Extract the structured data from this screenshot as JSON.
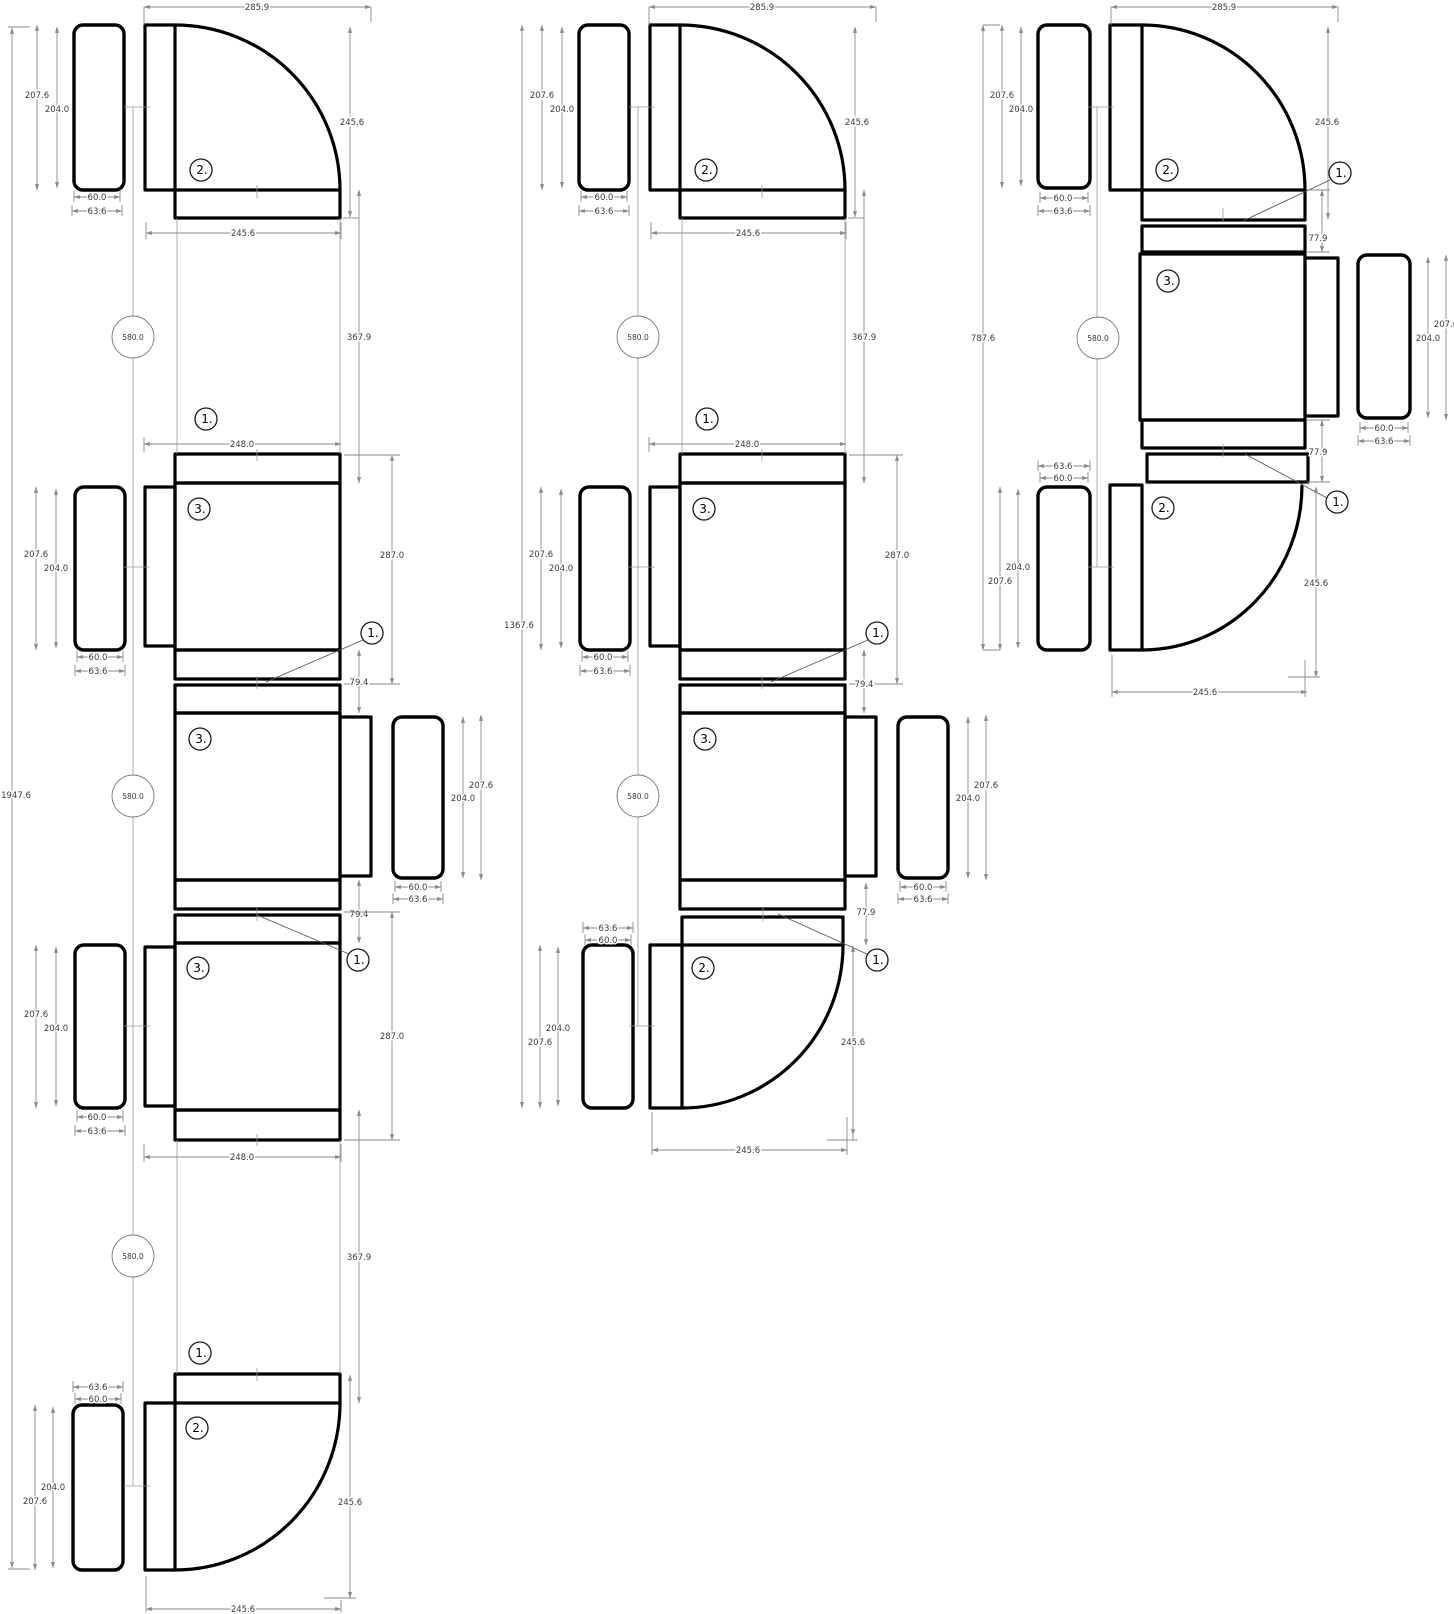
{
  "drawing": {
    "background_color": "#ffffff",
    "furniture_line_color": "#000000",
    "dimension_line_color": "#8a8a8a",
    "balloons": {
      "connector": "1.",
      "corner_table": "2.",
      "rect_table": "3."
    },
    "dims": {
      "overall_left": "1947.6",
      "overall_middle": "1367.6",
      "overall_right": "787.6",
      "module_pitch": "580.0",
      "corner_width": "285.9",
      "corner_radius": "245.6",
      "chair_outer_depth": "207.6",
      "chair_depth": "204.0",
      "chair_width": "60.0",
      "chair_outer_width": "63.6",
      "module_gap": "367.9",
      "table_width": "248.0",
      "table_depth": "287.0",
      "connector_gap_a": "79.4",
      "connector_gap_b": "77.9"
    }
  }
}
